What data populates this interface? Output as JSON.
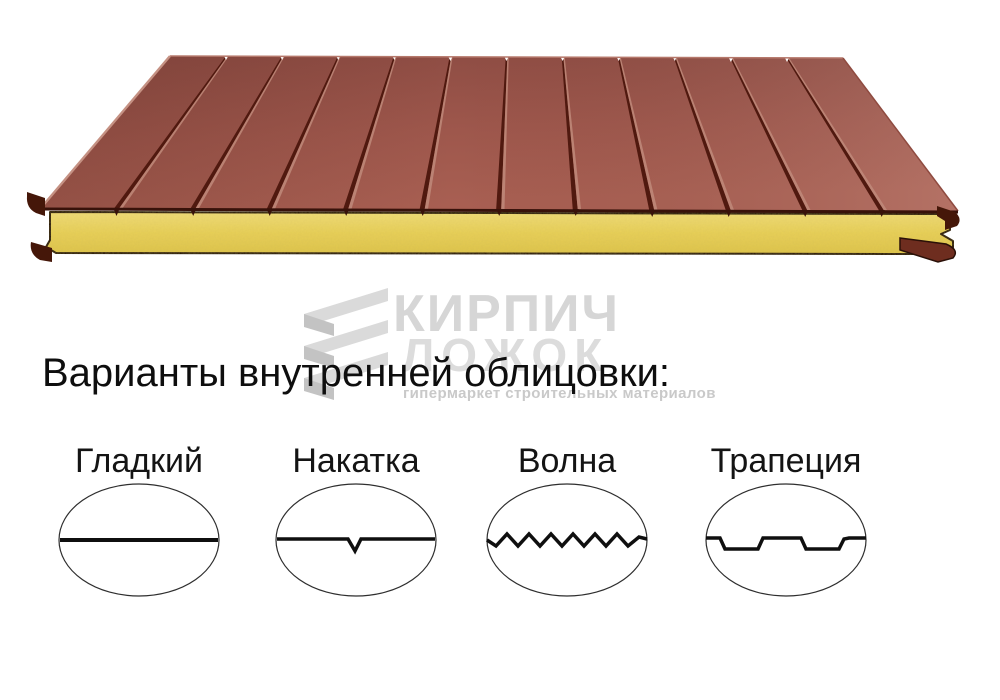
{
  "heading": {
    "text": "Варианты внутренней облицовки:",
    "color": "#0e0e0e"
  },
  "watermark": {
    "brand": "КИРПИЧ",
    "brand_line2": "ЛОЖОК",
    "tagline": "гипермаркет строительных материалов",
    "text_color": "#d6d6d6",
    "icon": "ribbon-zigzag-icon"
  },
  "panel_illustration": {
    "kind": "sandwich-panel 3d render",
    "facing_color": "#a25a4e",
    "groove_color": "#50190f",
    "core_color": "#e9d25f",
    "outline_color": "#2a1008",
    "board_count": 12
  },
  "cladding_options": [
    {
      "label": "Гладкий",
      "profile": "smooth"
    },
    {
      "label": "Накатка",
      "profile": "notched"
    },
    {
      "label": "Волна",
      "profile": "wave"
    },
    {
      "label": "Трапеция",
      "profile": "trapezoid"
    }
  ]
}
